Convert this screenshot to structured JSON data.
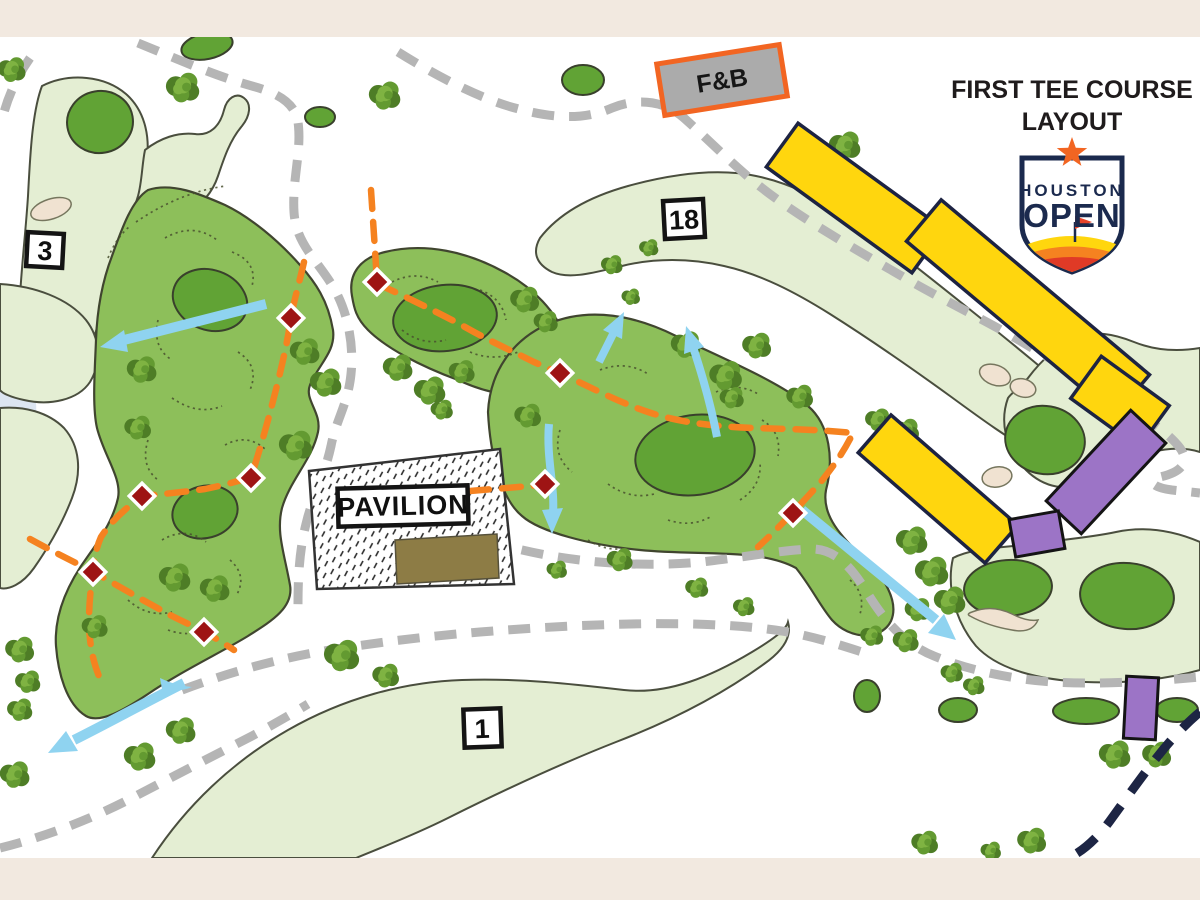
{
  "header": {
    "title_line1": "FIRST TEE COURSE",
    "title_line2": "LAYOUT"
  },
  "logo": {
    "line1": "HOUSTON",
    "line2": "OPEN"
  },
  "labels": {
    "pavilion": "PAVILION",
    "food_beverage": "F&B"
  },
  "holes": {
    "hole_3": "3",
    "hole_18": "18",
    "hole_1": "1"
  },
  "colors": {
    "fairway_light": "#e4eed3",
    "green_medium": "#8dbf5a",
    "green_dark": "#61a335",
    "tree_dark": "#4e7d26",
    "tree_mid": "#639a31",
    "tree_light": "#7fb342",
    "path_gray": "#b5b5b5",
    "route_orange": "#f58220",
    "marker_red": "#9e1414",
    "arrow_blue": "#8fd3f0",
    "grandstand_yellow": "#ffd60e",
    "structure_purple": "#9c74c6",
    "exit_navy": "#1d2544",
    "sand_tan": "#f0e2d1",
    "pavilion_brown": "#8d7c45",
    "fnb_gray": "#ababab",
    "border_beige": "#f2e9e0",
    "logo_navy": "#1b2a4e",
    "logo_orange": "#f26522",
    "water_blue": "#dce5f1"
  }
}
